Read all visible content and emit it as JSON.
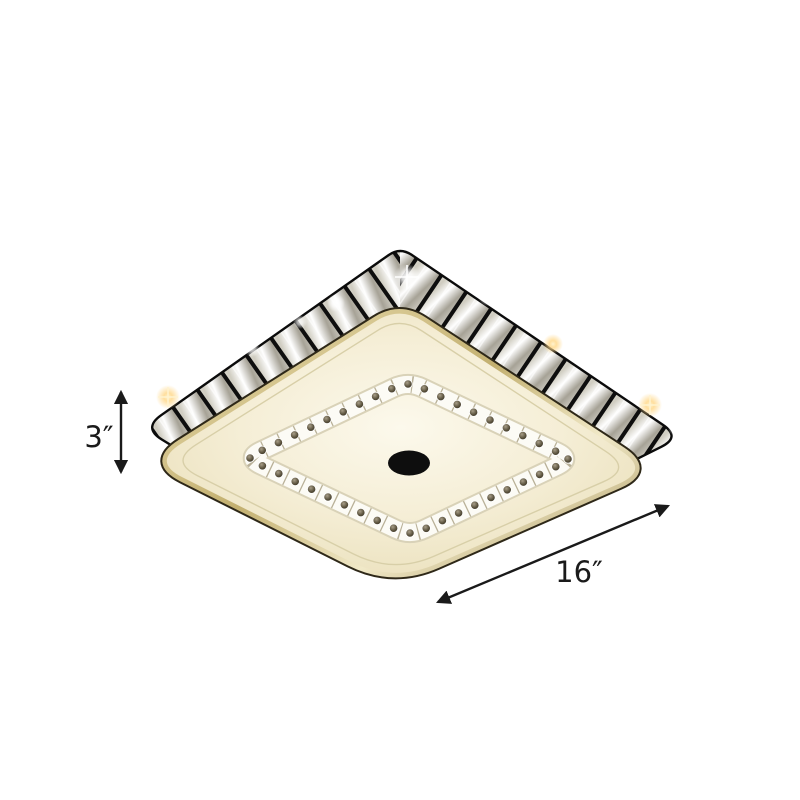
{
  "page": {
    "background": "#ffffff"
  },
  "product": {
    "description": "square-crystal-flush-mount-ceiling-light",
    "colors": {
      "face_center": "#fcf9ec",
      "face_mid": "#f5eed6",
      "face_edge": "#ebe1bd",
      "rim_gold": "#c3b070",
      "rim_dark_seam": "#2e2818",
      "band_trim": "#141414",
      "crystal_light": "#f4f2ea",
      "crystal_shadow": "#a39e90",
      "sparkle_warm": "#ffd98d",
      "dot_crystal": "#46402f",
      "center_cap": "#0e0e0e",
      "annotation": "#1a1a1a"
    }
  },
  "annotations": {
    "height": {
      "label": "3″"
    },
    "width": {
      "label": "16″"
    }
  }
}
